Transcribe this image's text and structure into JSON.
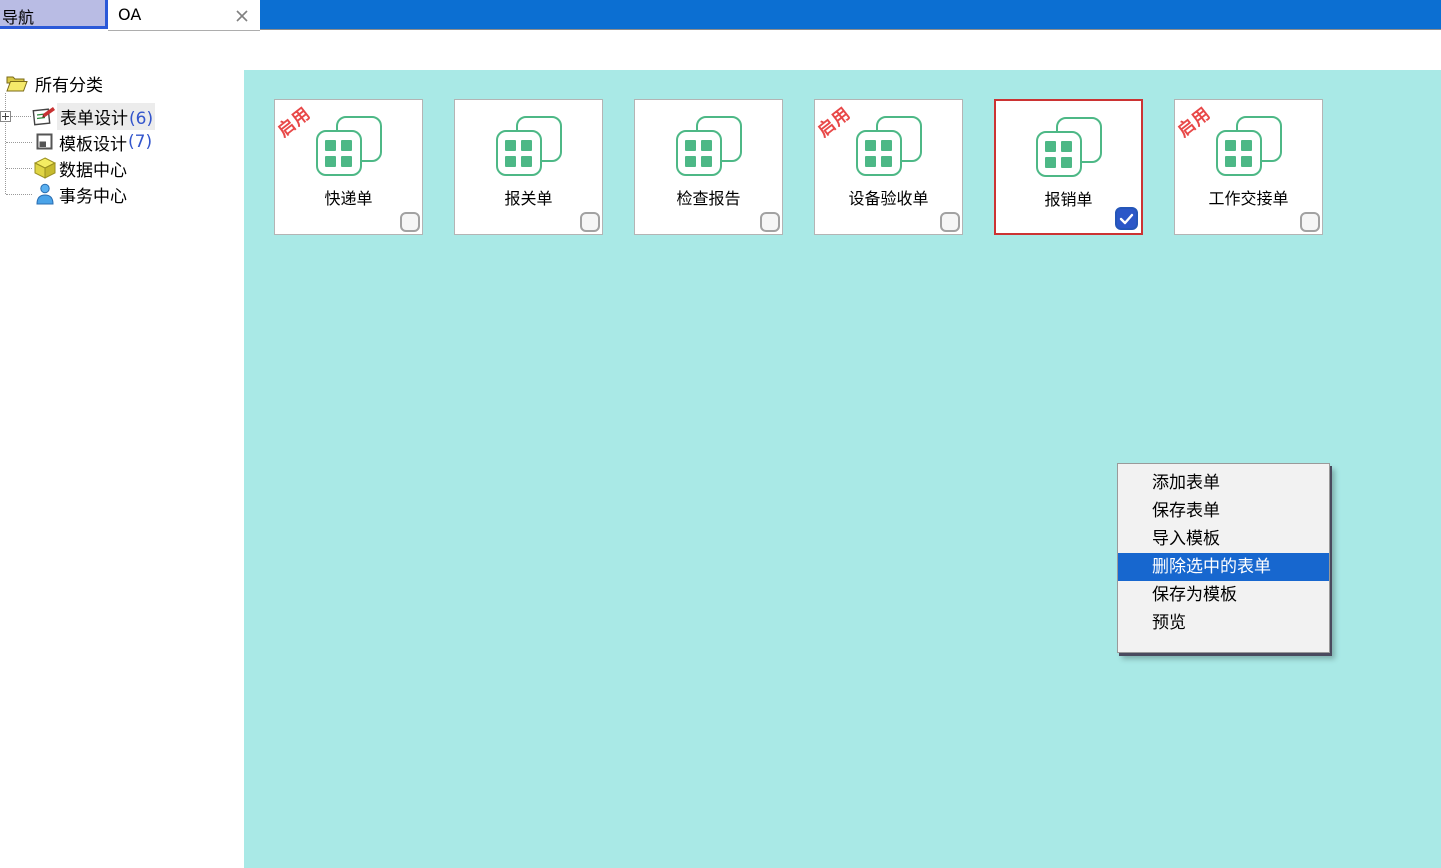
{
  "window": {
    "tabs": [
      {
        "label": "导航"
      },
      {
        "label": "OA"
      }
    ]
  },
  "sidebar": {
    "root_label": "所有分类",
    "items": [
      {
        "label": "表单设计",
        "count": "(6)"
      },
      {
        "label": "模板设计",
        "count": "(7)"
      },
      {
        "label": "数据中心",
        "count": ""
      },
      {
        "label": "事务中心",
        "count": ""
      }
    ]
  },
  "cards": [
    {
      "label": "快递单",
      "stamp": "启用",
      "checked": false,
      "selected": false
    },
    {
      "label": "报关单",
      "stamp": "",
      "checked": false,
      "selected": false
    },
    {
      "label": "检查报告",
      "stamp": "",
      "checked": false,
      "selected": false
    },
    {
      "label": "设备验收单",
      "stamp": "启用",
      "checked": false,
      "selected": false
    },
    {
      "label": "报销单",
      "stamp": "",
      "checked": true,
      "selected": true
    },
    {
      "label": "工作交接单",
      "stamp": "启用",
      "checked": false,
      "selected": false
    }
  ],
  "context_menu": {
    "items": [
      {
        "label": "添加表单",
        "highlighted": false
      },
      {
        "label": "保存表单",
        "highlighted": false
      },
      {
        "label": "导入模板",
        "highlighted": false
      },
      {
        "label": "删除选中的表单",
        "highlighted": true
      },
      {
        "label": "保存为模板",
        "highlighted": false
      },
      {
        "label": "预览",
        "highlighted": false
      }
    ]
  },
  "colors": {
    "main_panel_bg": "#a9e9e6",
    "tab_bar_blue": "#0c6fd2",
    "nav_tab_bg": "#b9bce4",
    "card_icon_green": "#4db886",
    "stamp_red": "#e84848",
    "selected_card_border": "#cc3333",
    "menu_highlight_blue": "#1767cf",
    "checkbox_checked_blue": "#2b57c8",
    "tree_count_blue": "#3355cc"
  }
}
